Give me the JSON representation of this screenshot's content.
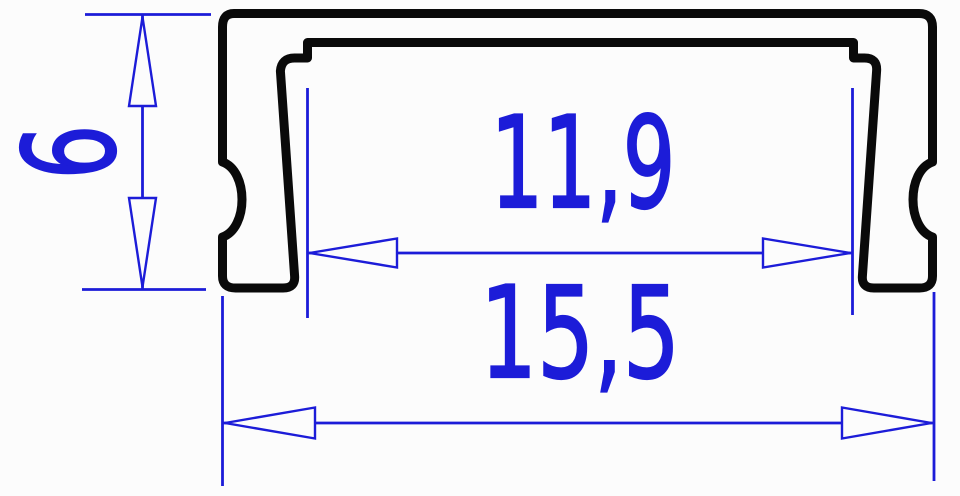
{
  "drawing": {
    "labels": {
      "height": "6",
      "inner_width": "11,9",
      "outer_width": "15,5"
    },
    "colors": {
      "dimension_blue": "#1c1cd8",
      "outline_black": "#0a0a0a",
      "background": "#fcfcfc"
    }
  }
}
